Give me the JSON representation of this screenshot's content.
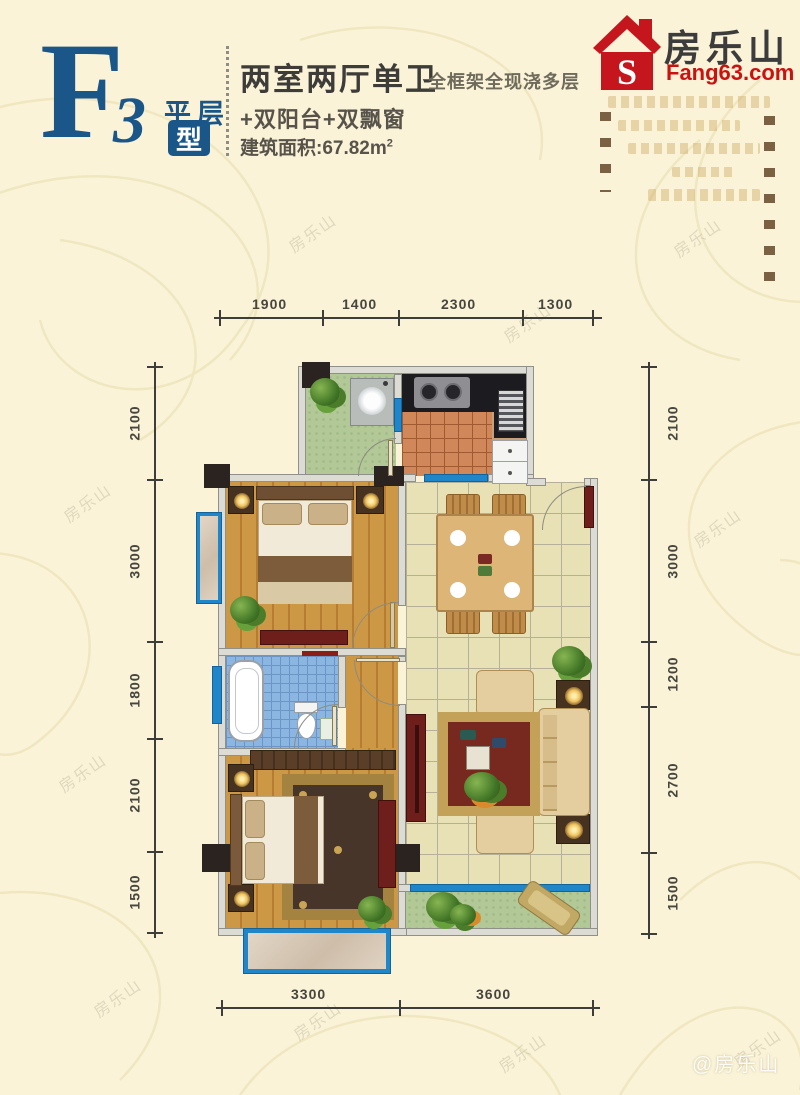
{
  "header": {
    "plan_letter": "F",
    "plan_number": "3",
    "plan_tag": "平层",
    "plan_tag_boxed": "型",
    "title": "两室两厅单卫",
    "title_note": "全框架全现浇多层",
    "subtitle": "+双阳台+双飘窗",
    "area_label": "建筑面积:67.82m",
    "area_sup": "2"
  },
  "logo": {
    "brand": "房乐山",
    "domain": "Fang63.com",
    "icon_letter": "S"
  },
  "watermark": {
    "text": "房乐山",
    "credit": "@房乐山"
  },
  "floorplan": {
    "dimensions": {
      "top": [
        "1900",
        "1400",
        "2300",
        "1300"
      ],
      "bottom": [
        "3300",
        "3600"
      ],
      "left": [
        "2100",
        "3000",
        "1800",
        "2100",
        "1500"
      ],
      "right": [
        "2100",
        "3000",
        "1200",
        "2700",
        "1500"
      ]
    }
  },
  "palette": {
    "accent_blue": "#1a5688",
    "logo_red": "#c5161d",
    "window_blue": "#1e86c9",
    "wall_fill": "#dcdbd4",
    "column_dark": "#2b2320",
    "wood_floor": "#c8923f",
    "tile_beige": "#e9e1b6",
    "tile_kitchen": "#d0875a",
    "bath_blue": "#8cb6e2",
    "balcony_green": "#b2c897",
    "background_cream": "#faf3d8"
  }
}
